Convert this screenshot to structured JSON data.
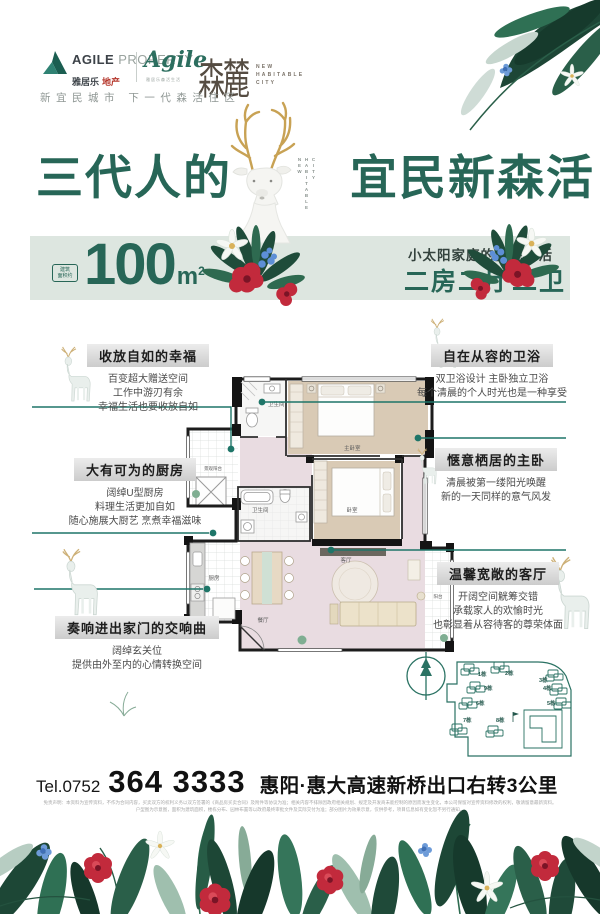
{
  "colors": {
    "accent_teal": "#276657",
    "connector_teal": "#1e7568",
    "band_bg": "#dde6e0",
    "flower_red": "#c22a3c",
    "antler_gold": "#c8a254"
  },
  "header": {
    "brand_en": "AGILE",
    "brand_en2": "PROPERTY",
    "brand_cn": "雅居乐",
    "brand_cn2": "地产",
    "script": "Agile",
    "script_sub": "雅居乐森活生活",
    "project_name": "森麓",
    "project_sub": [
      "NEW",
      "HABITABLE",
      "CITY"
    ],
    "tagline": "新宜民城市 下一代森活住区"
  },
  "hero": {
    "title_left": "三代人的",
    "title_right": "宜民新森活",
    "vertical_words": [
      "NEW",
      "HABITABLE",
      "CITY"
    ],
    "badge_line1": "建筑",
    "badge_line2": "面积约",
    "area_value": "100",
    "area_unit": "m",
    "area_sup": "2",
    "sub1": "小太阳家庭的宜民森活",
    "sub2": "二房二厅二卫"
  },
  "features": {
    "left": [
      {
        "title": "收放自如的幸福",
        "lines": [
          "百变超大赠送空间",
          "工作中游刃有余",
          "幸福生活也要收放自如"
        ]
      },
      {
        "title": "大有可为的厨房",
        "lines": [
          "阔绰U型厨房",
          "料理生活更加自如",
          "随心施展大厨艺 烹煮幸福滋味"
        ]
      },
      {
        "title": "奏响进出家门的交响曲",
        "lines": [
          "阔绰玄关位",
          "提供由外至内的心情转换空间"
        ]
      }
    ],
    "right": [
      {
        "title": "自在从容的卫浴",
        "lines": [
          "双卫浴设计 主卧独立卫浴",
          "每个清晨的个人时光也是一种享受"
        ]
      },
      {
        "title": "惬意栖居的主卧",
        "lines": [
          "清晨被第一缕阳光唤醒",
          "新的一天同样的意气风发"
        ]
      },
      {
        "title": "温馨宽敞的客厅",
        "lines": [
          "开阔空间觥筹交错",
          "承载家人的欢愉时光",
          "也彰显着从容待客的尊荣体面"
        ]
      }
    ]
  },
  "floorplan": {
    "labels": {
      "bath1": "卫生间",
      "master": "主卧室",
      "balcony_left": "景观阳台",
      "bath2": "卫生间",
      "bedroom2": "卧室",
      "kitchen": "厨房",
      "dining": "餐厅",
      "living": "客厅",
      "balcony_right": "阳台"
    }
  },
  "siteplan": {
    "buildings": [
      "1栋",
      "2栋",
      "3栋",
      "9栋",
      "4栋",
      "6栋",
      "5栋",
      "7栋",
      "8栋"
    ]
  },
  "footer": {
    "tel_label": "Tel.0752",
    "tel_number": "364 3333",
    "address": "惠阳·惠大高速新桥出口右转3公里",
    "fine_print_1": "免责声明：本资料为宣传资料，不作为合同内容，买卖双方的权利义务以双方签署的《商品房买卖合同》及附件等协议为准；相关内容不排除因政府相关规划、规定及开发商未能控制的原因而发生变化，本公司保留对宣传资料修改的权利，敬请留意最新资料。",
    "fine_print_2": "户型图为示意图，面积为建筑面积，楼栋分布、园林布置等以政府最终审批文件及实际交付为准；部分图片为效果示意，仅供参考，项目信息如有变化恕不另行通知。"
  }
}
